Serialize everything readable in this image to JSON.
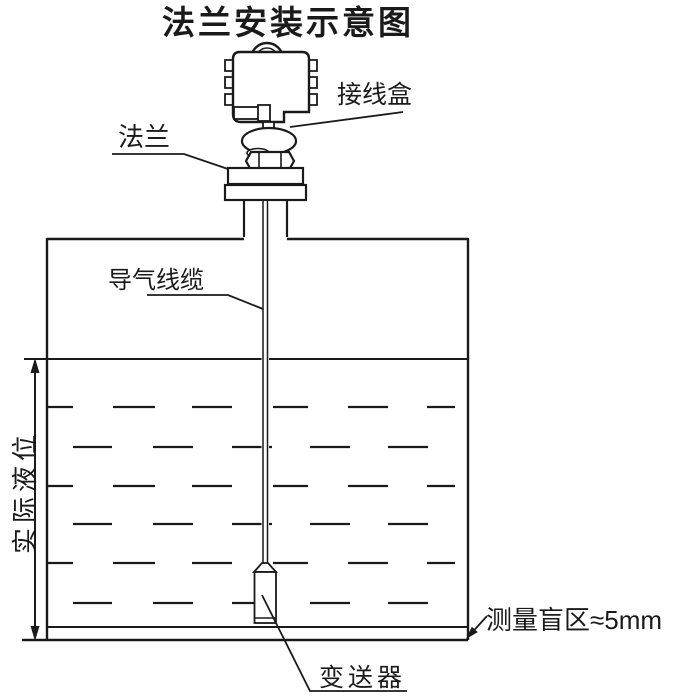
{
  "diagram": {
    "title": "法兰安装示意图",
    "labels": {
      "junction_box": "接线盒",
      "flange": "法兰",
      "air_cable": "导气线缆",
      "actual_level": "实际液位",
      "blind_zone": "测量盲区≈5mm",
      "transmitter": "变送器"
    },
    "colors": {
      "line": "#1a1a1a",
      "background": "#ffffff"
    }
  }
}
